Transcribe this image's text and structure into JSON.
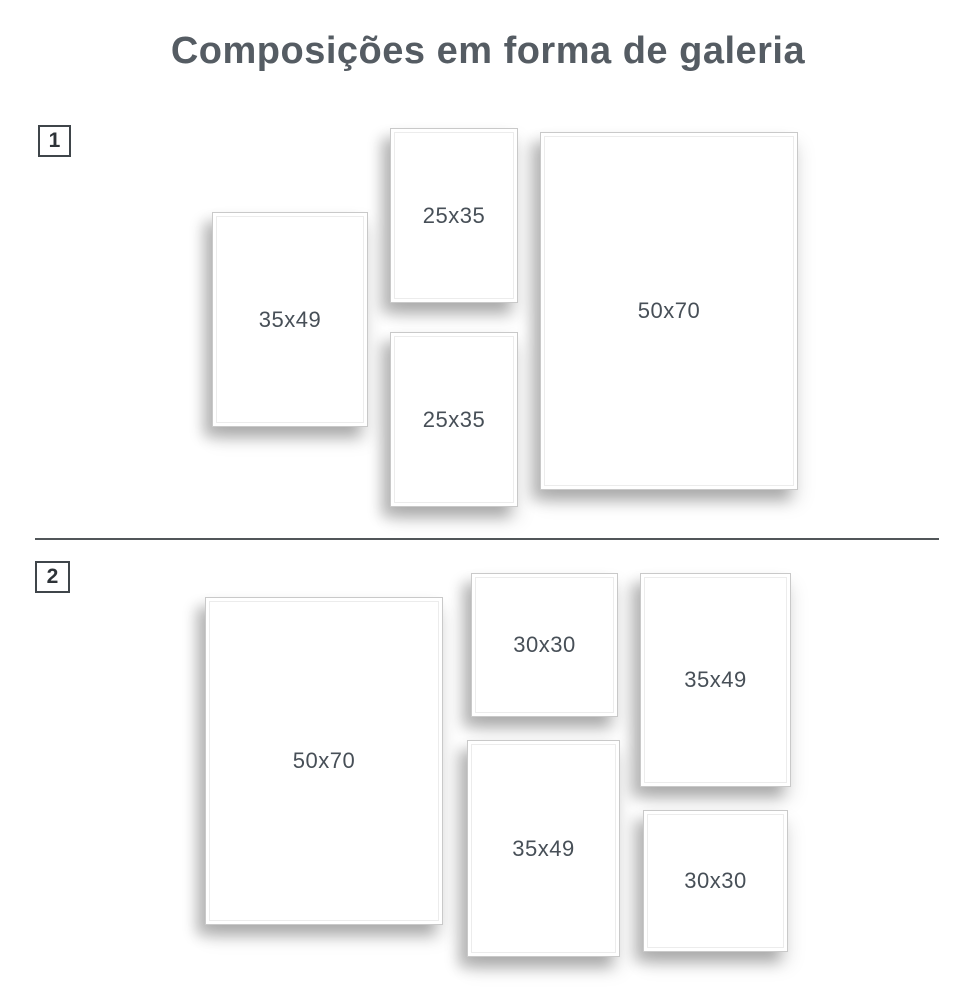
{
  "title": "Composições em forma de galeria",
  "colors": {
    "background": "#ffffff",
    "title": "#555c63",
    "label": "#474f57",
    "frame_border": "#c9c9c9",
    "frame_inner_border": "#ececec",
    "badge_border": "#3f454a",
    "badge_text": "#2e3338",
    "divider": "#515659"
  },
  "sections": [
    {
      "number": "1",
      "frames": [
        {
          "label": "35x49"
        },
        {
          "label": "25x35"
        },
        {
          "label": "25x35"
        },
        {
          "label": "50x70"
        }
      ]
    },
    {
      "number": "2",
      "frames": [
        {
          "label": "50x70"
        },
        {
          "label": "30x30"
        },
        {
          "label": "35x49"
        },
        {
          "label": "35x49"
        },
        {
          "label": "30x30"
        }
      ]
    }
  ]
}
